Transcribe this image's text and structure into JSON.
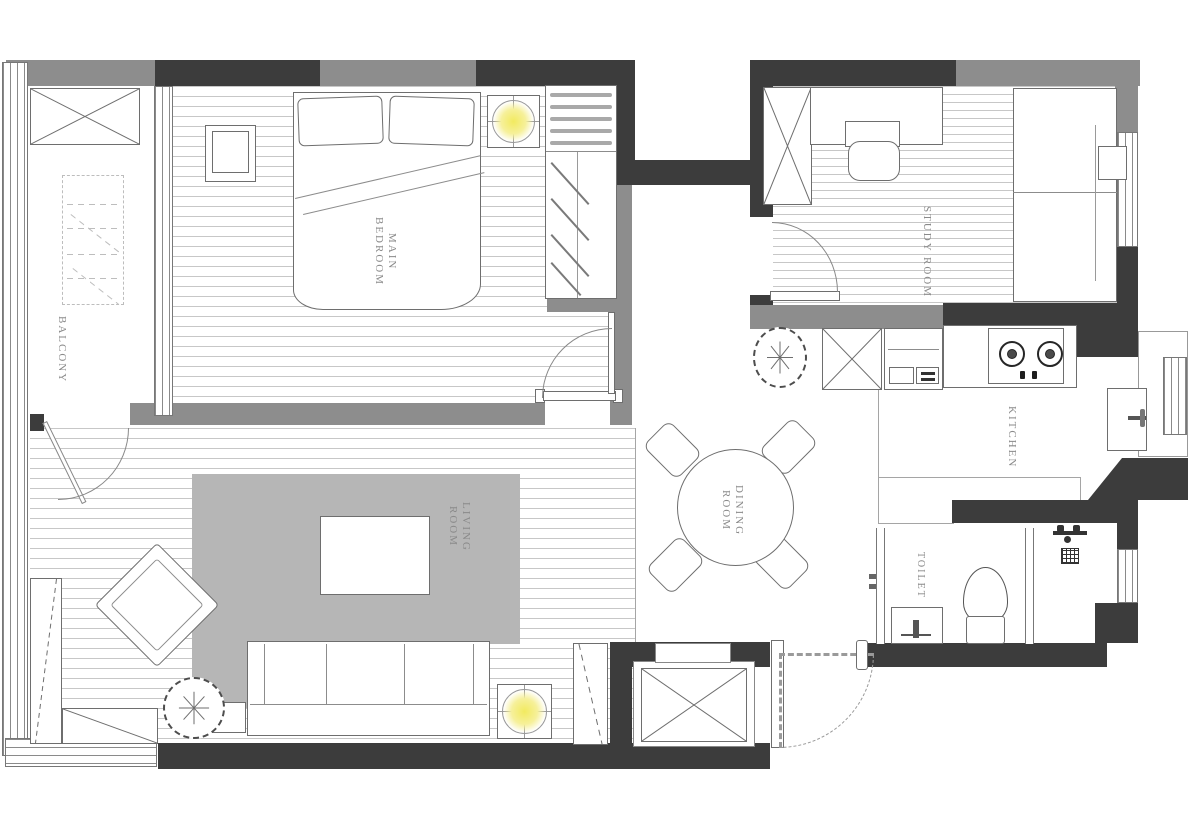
{
  "title": "Apartment floor plan",
  "colors": {
    "wall_dark": "#3c3c3c",
    "wall_gray": "#8d8d8d",
    "rug_gray": "#b6b6b6",
    "floor_line": "#c7c7c7",
    "label_gray": "#8a8a8a",
    "lamp_yellow": "#f2ea5f",
    "background": "#ffffff"
  },
  "rooms": {
    "balcony": {
      "label": "BALCONY"
    },
    "main_bedroom": {
      "label": "MAIN\nBEDROOM"
    },
    "study_room": {
      "label": "STUDY ROOM"
    },
    "kitchen": {
      "label": "KITCHEN"
    },
    "dining_room": {
      "label": "DINING ROOM"
    },
    "living_room": {
      "label": "LIVING ROOM"
    },
    "toilet": {
      "label": "TOILET"
    }
  }
}
